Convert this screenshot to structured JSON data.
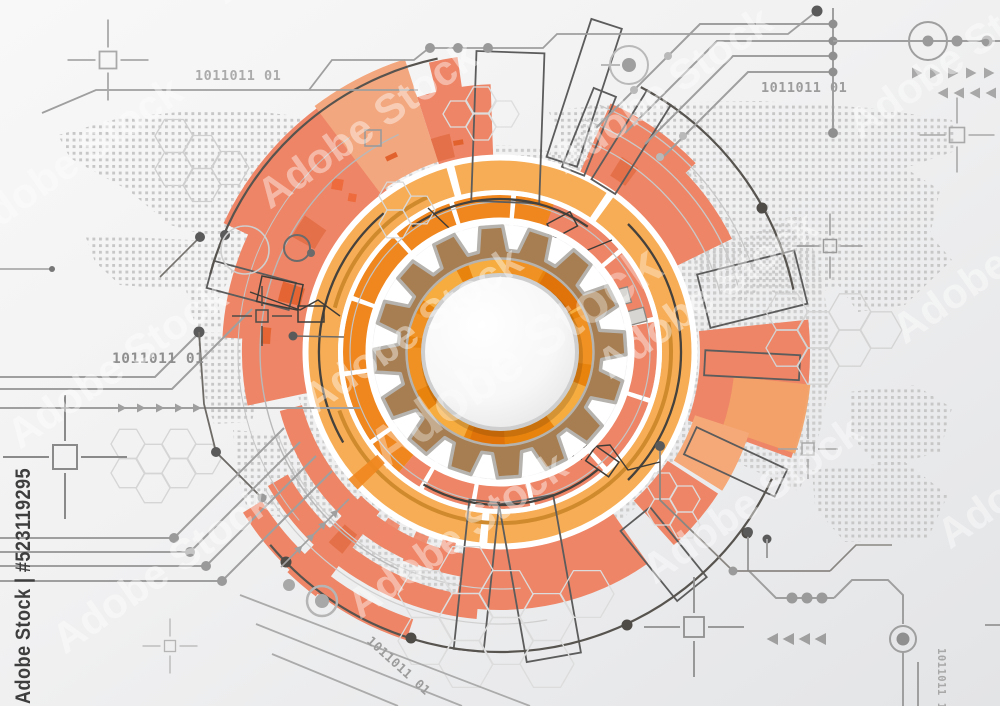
{
  "watermark": {
    "stock_id": "Adobe Stock | #523119295",
    "tile": "Adobe Stock"
  },
  "binary_codes": {
    "top_left": "1011011 01",
    "top_right": "1011011 01",
    "mid_left": "1011011 01",
    "bottom_center": "1011011 01",
    "bottom_right": "1011011 1"
  },
  "icons": {
    "center_motif": "gear-icon",
    "registration_marks": "crosshair-icon",
    "direction_marks": "triangle-arrow-icon"
  },
  "palette": {
    "coral": "#EE8566",
    "coral_deep": "#E26E46",
    "peach": "#F3A77E",
    "yellow": "#F7AD55",
    "orange": "#F0861E",
    "orange_deep": "#E8830E",
    "segment_light": "#F6AC3F",
    "segment_mid": "#EF9223",
    "gear_brown": "#A67E52",
    "gear_outline": "#B6B3AE",
    "trace_gray": "#9F9F9F",
    "dark_line": "#57534E",
    "map_dot": "#C7C7C7",
    "bg_light": "#F6F6F6",
    "bg_dark": "#E6E7E9"
  }
}
